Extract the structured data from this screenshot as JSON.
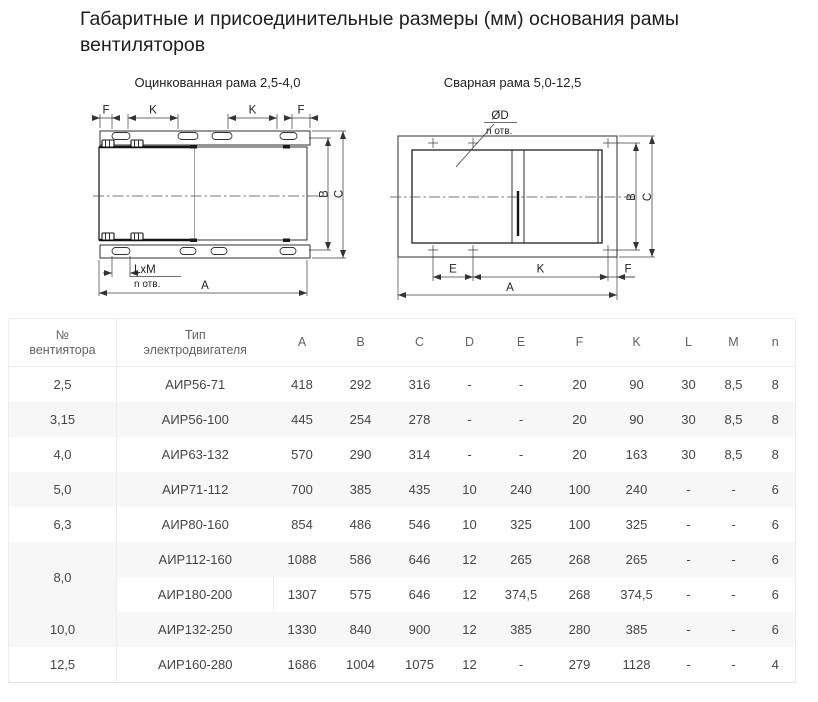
{
  "page": {
    "title": "Габаритные и присоединительные размеры (мм) основания рамы вентиляторов"
  },
  "diagrams": {
    "left": {
      "caption": "Оцинкованная рама 2,5-4,0",
      "labels": {
        "f": "F",
        "k": "K",
        "b": "B",
        "c": "C",
        "a": "A",
        "lxm": "LxM",
        "n_otv": "n отв."
      }
    },
    "right": {
      "caption": "Сварная рама 5,0-12,5",
      "labels": {
        "od": "ØD",
        "n_otv": "n отв.",
        "b": "B",
        "c": "C",
        "e": "E",
        "k": "K",
        "f": "F",
        "a": "A"
      }
    }
  },
  "table": {
    "header": {
      "no_line1": "№",
      "no_line2": "вентиятора",
      "type_line1": "Тип",
      "type_line2": "электродвигателя",
      "dims": [
        "A",
        "B",
        "C",
        "D",
        "E",
        "F",
        "K",
        "L",
        "M",
        "n"
      ]
    },
    "rows": [
      {
        "no": "2,5",
        "type": "АИР56-71",
        "vals": [
          "418",
          "292",
          "316",
          "-",
          "-",
          "20",
          "90",
          "30",
          "8,5",
          "8"
        ]
      },
      {
        "no": "3,15",
        "type": "АИР56-100",
        "vals": [
          "445",
          "254",
          "278",
          "-",
          "-",
          "20",
          "90",
          "30",
          "8,5",
          "8"
        ]
      },
      {
        "no": "4,0",
        "type": "АИР63-132",
        "vals": [
          "570",
          "290",
          "314",
          "-",
          "-",
          "20",
          "163",
          "30",
          "8,5",
          "8"
        ]
      },
      {
        "no": "5,0",
        "type": "АИР71-112",
        "vals": [
          "700",
          "385",
          "435",
          "10",
          "240",
          "100",
          "240",
          "-",
          "-",
          "6"
        ]
      },
      {
        "no": "6,3",
        "type": "АИР80-160",
        "vals": [
          "854",
          "486",
          "546",
          "10",
          "325",
          "100",
          "325",
          "-",
          "-",
          "6"
        ]
      },
      {
        "no": "8,0",
        "type": "АИР112-160",
        "vals": [
          "1088",
          "586",
          "646",
          "12",
          "265",
          "268",
          "265",
          "-",
          "-",
          "6"
        ]
      },
      {
        "type": "АИР180-200",
        "vals": [
          "1307",
          "575",
          "646",
          "12",
          "374,5",
          "268",
          "374,5",
          "-",
          "-",
          "6"
        ]
      },
      {
        "no": "10,0",
        "type": "АИР132-250",
        "vals": [
          "1330",
          "840",
          "900",
          "12",
          "385",
          "280",
          "385",
          "-",
          "-",
          "6"
        ]
      },
      {
        "no": "12,5",
        "type": "АИР160-280",
        "vals": [
          "1686",
          "1004",
          "1075",
          "12",
          "-",
          "279",
          "1128",
          "-",
          "-",
          "4"
        ]
      }
    ]
  }
}
